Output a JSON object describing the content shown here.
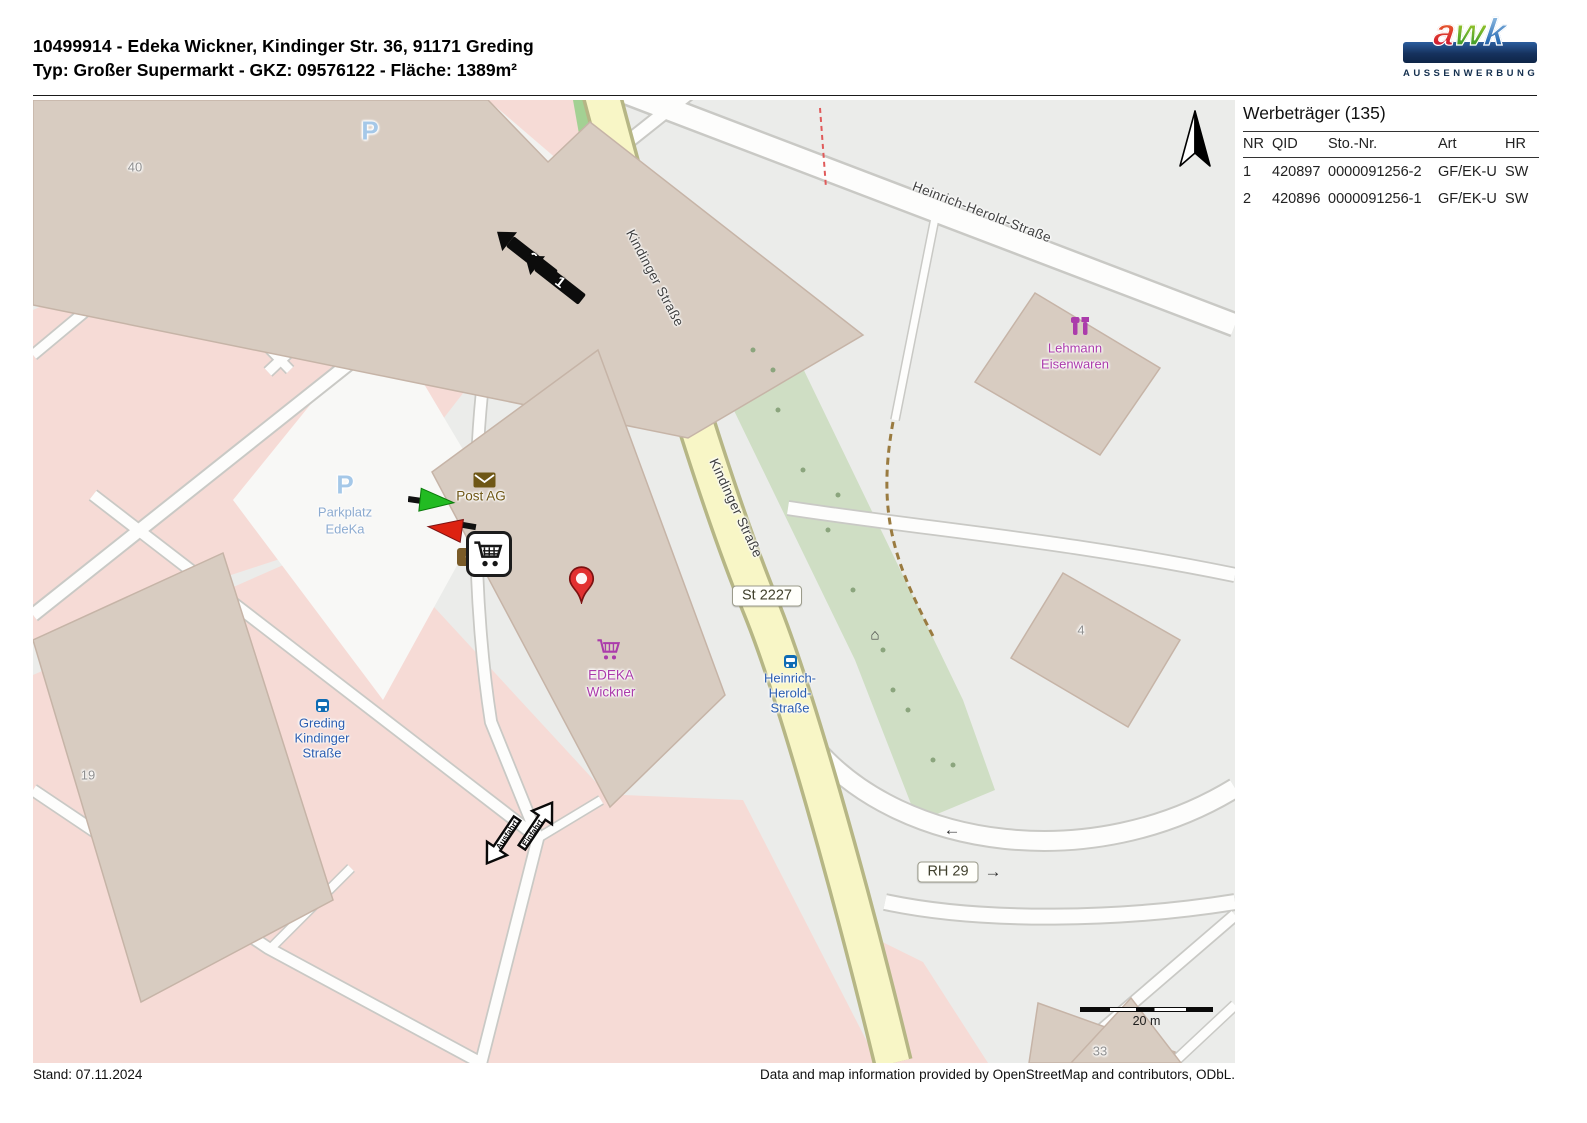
{
  "header": {
    "line1": "10499914 - Edeka Wickner, Kindinger Str. 36, 91171 Greding",
    "line2": "Typ: Großer Supermarkt - GKZ: 09576122 - Fläche: 1389m²"
  },
  "logo": {
    "letters": [
      "a",
      "w",
      "k"
    ],
    "subtitle": "AUSSENWERBUNG"
  },
  "panel": {
    "title": "Werbeträger (135)",
    "columns": [
      "NR",
      "QID",
      "Sto.-Nr.",
      "Art",
      "HR"
    ],
    "rows": [
      {
        "nr": "1",
        "qid": "420897",
        "sto": "0000091256-2",
        "art": "GF/EK-U",
        "hr": "SW"
      },
      {
        "nr": "2",
        "qid": "420896",
        "sto": "0000091256-1",
        "art": "GF/EK-U",
        "hr": "SW"
      }
    ]
  },
  "map": {
    "streets": {
      "kindinger1": "Kindinger Straße",
      "kindinger2": "Kindinger Straße",
      "heinrich": "Heinrich-Herold-Straße"
    },
    "badges": {
      "st2227": "St 2227",
      "rh29": "RH 29"
    },
    "pois": {
      "post": "Post AG",
      "edeka_line1": "EDEKA",
      "edeka_line2": "Wickner",
      "lehmann_line1": "Lehmann",
      "lehmann_line2": "Eisenwaren",
      "parkplatz_p": "P",
      "parkplatz_line1": "Parkplatz",
      "parkplatz_line2": "EdeKa",
      "p_top": "P"
    },
    "bus_stops": {
      "greding": [
        "Greding",
        "Kindinger",
        "Straße"
      ],
      "heinrich": [
        "Heinrich-",
        "Herold-",
        "Straße"
      ]
    },
    "house_numbers": {
      "h40": "40",
      "h19": "19",
      "h4": "4",
      "h33": "33"
    },
    "markers": {
      "billboard1": "1",
      "billboard2": "2",
      "ausfahrt": "Ausfahrt",
      "einfahrt": "Einfahrt"
    },
    "oneway": {
      "left": "←",
      "right": "→"
    },
    "scale_label": "20 m"
  },
  "footer": {
    "stand": "Stand: 07.11.2024",
    "attribution": "Data and map information provided by OpenStreetMap and contributors, ODbL."
  },
  "colors": {
    "road_yellow": "#f8f6c6",
    "landuse_pink": "#f6dbd6",
    "building_beige": "#d8ccc1",
    "shop_purple": "#ab3bab",
    "transport_blue": "#2a5db0",
    "amenity_brown": "#6f5716",
    "logo_navy": "#16325e"
  }
}
